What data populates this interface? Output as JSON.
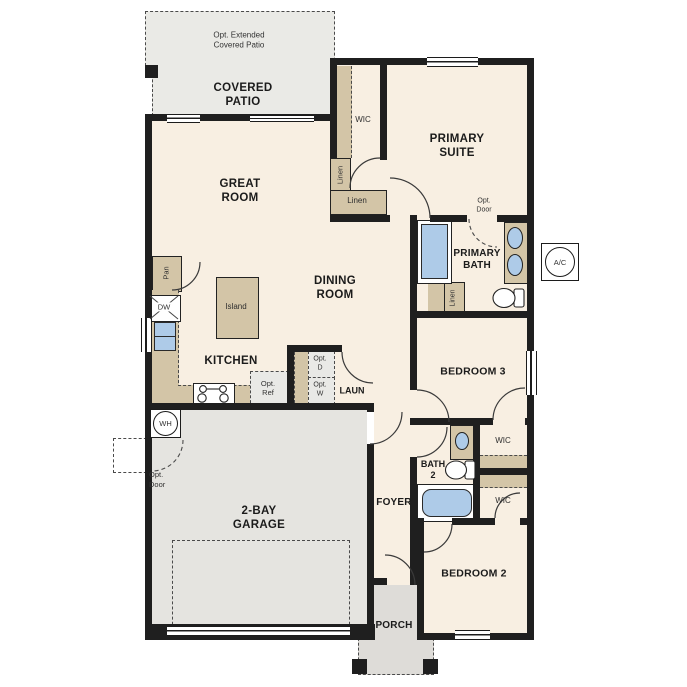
{
  "colors": {
    "wall": "#1f1f1f",
    "floor": "#f8efe2",
    "outdoor": "#eaeae6",
    "garage_floor": "#e5e4e0",
    "porch_floor": "#dedddar",
    "porch": "#dedcd8",
    "cabinet": "#d3c5a7",
    "fixture": "#aecbe8",
    "appliance": "#e9e9e6"
  },
  "labels": {
    "opt_extended_patio": "Opt. Extended\nCovered Patio",
    "covered_patio": "COVERED\nPATIO",
    "primary_wic": "WIC",
    "primary_suite": "PRIMARY\nSUITE",
    "linen_tall": "Linen",
    "linen_closet": "Linen",
    "great_room": "GREAT\nROOM",
    "opt_door_bath": "Opt.\nDoor",
    "primary_bath": "PRIMARY\nBATH",
    "bath_linen": "Linen",
    "ac_unit": "A/C",
    "dining_room": "DINING\nROOM",
    "island": "Island",
    "pantry": "Pan",
    "dishwasher": "DW",
    "kitchen": "KITCHEN",
    "bedroom3": "BEDROOM 3",
    "opt_ref": "Opt.\nRef",
    "opt_dryer": "Opt.\nD",
    "opt_washer": "Opt.\nW",
    "laundry": "LAUN",
    "bath2": "BATH\n2",
    "wic_bedroom3": "WIC",
    "wic_bedroom2": "WIC",
    "water_heater": "WH",
    "opt_door_garage": "Opt.\nDoor",
    "garage": "2-BAY\nGARAGE",
    "foyer": "FOYER",
    "bedroom2": "BEDROOM 2",
    "porch": "PORCH"
  }
}
